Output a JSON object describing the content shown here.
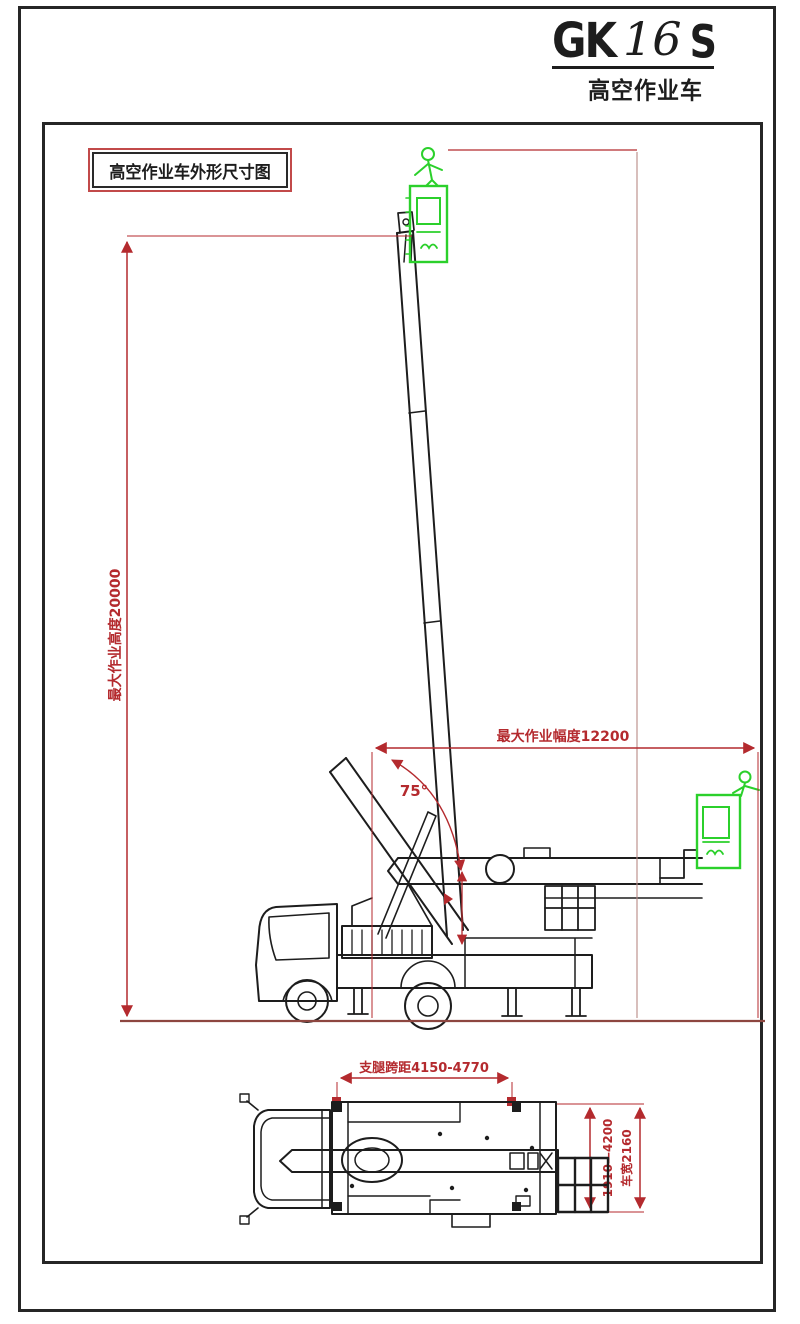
{
  "header": {
    "model_prefix": "GK",
    "model_mid": "16",
    "model_suffix": "S",
    "subtitle": "高空作业车"
  },
  "title_box": {
    "label": "高空作业车外形尺寸图"
  },
  "side_view": {
    "max_height_label": "最大作业高度20000",
    "outreach_label": "最大作业幅度12200",
    "boom_angle_label": "75°"
  },
  "top_view": {
    "outrigger_span_label": "支腿跨距4150-4770",
    "outrigger_extension_label": "1910—4200",
    "vehicle_width_label": "车宽2160"
  },
  "colors": {
    "dimension_red": "#b42a2e",
    "ground_red": "#8d4640",
    "line_black": "#1d1d1d",
    "basket_green": "#2bd02b"
  }
}
